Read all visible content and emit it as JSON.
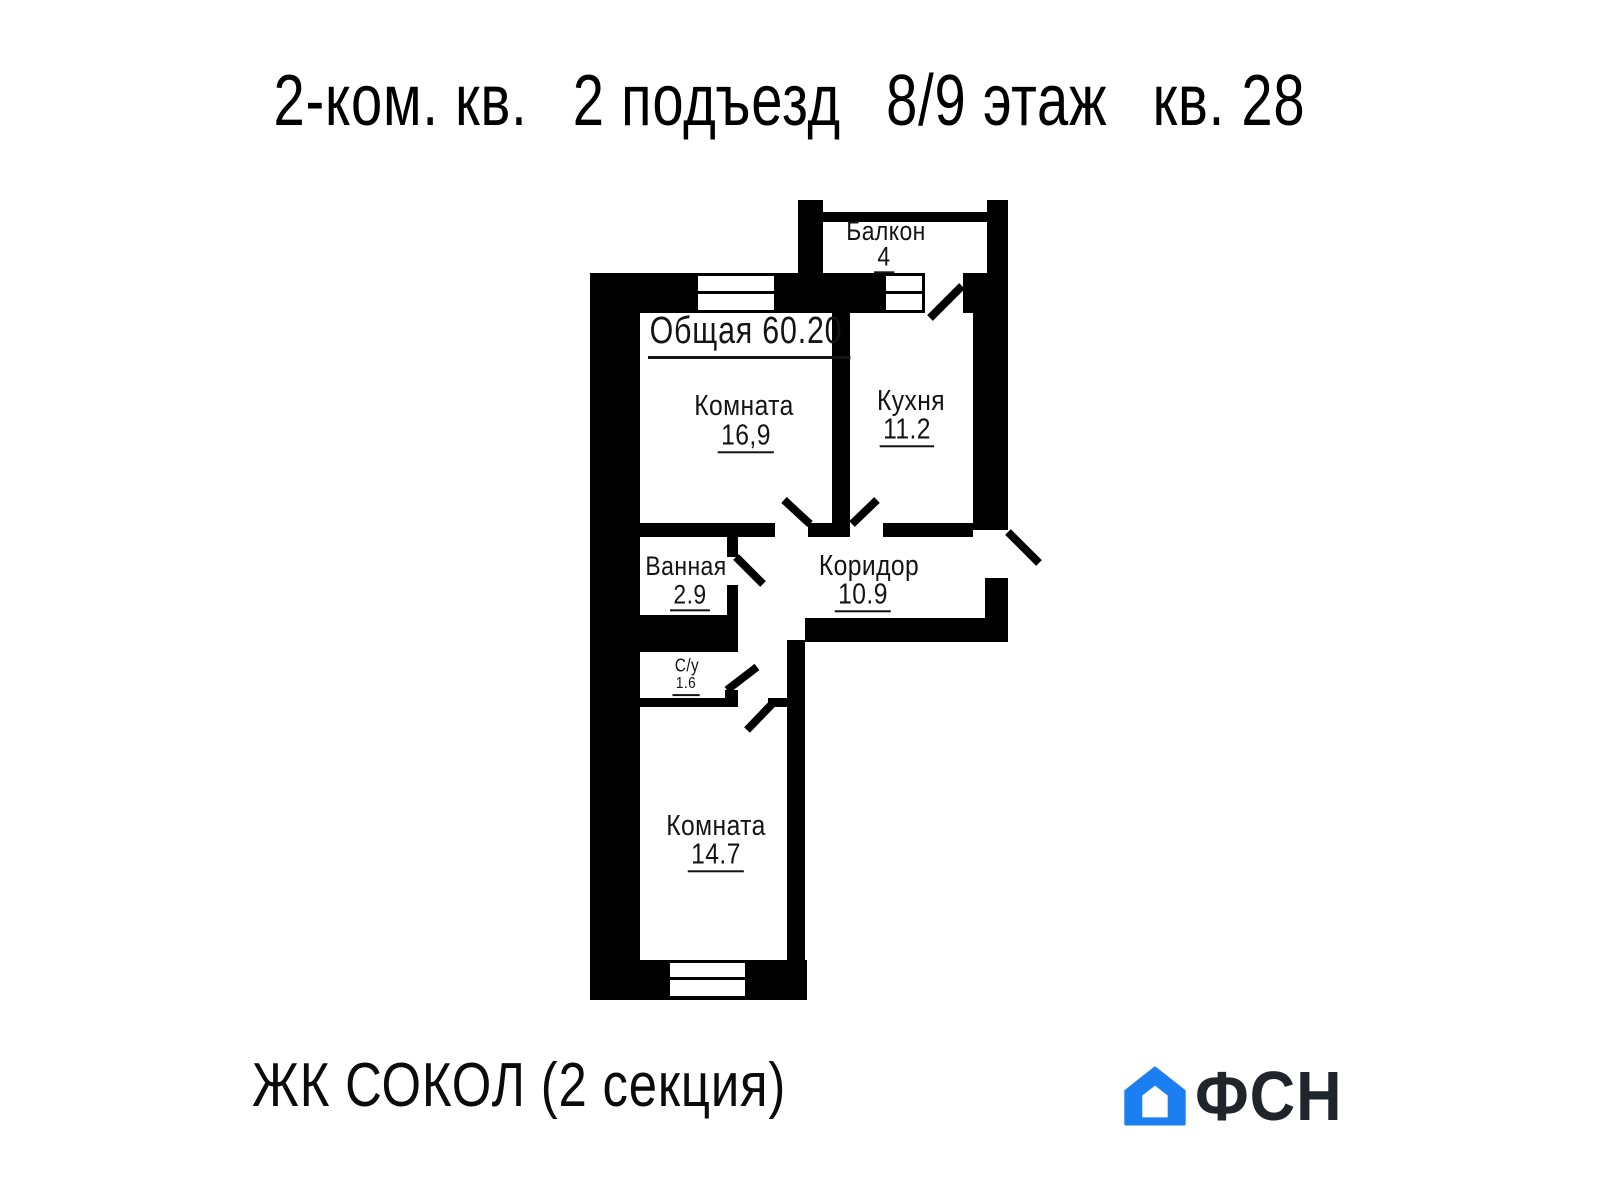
{
  "title": {
    "parts": [
      "2-ком. кв.",
      "2 подъезд",
      "8/9 этаж",
      "кв. 28"
    ]
  },
  "plan": {
    "total_area_label": "Общая 60.20",
    "rooms": {
      "balcony": {
        "name": "Балкон",
        "area": "4"
      },
      "room1": {
        "name": "Комната",
        "area": "16,9"
      },
      "kitchen": {
        "name": "Кухня",
        "area": "11.2"
      },
      "bath": {
        "name": "Ванная",
        "area": "2.9"
      },
      "corridor": {
        "name": "Коридор",
        "area": "10.9"
      },
      "su": {
        "name": "С/у",
        "area": "1.6"
      },
      "room2": {
        "name": "Комната",
        "area": "14.7"
      }
    }
  },
  "footer": {
    "project": "ЖК СОКОЛ (2 секция)",
    "logo_text": "ФСН"
  },
  "colors": {
    "ink": "#141414",
    "plan_black": "#000000",
    "logo_blue": "#1b7ff2",
    "logo_dark": "#20242b"
  }
}
